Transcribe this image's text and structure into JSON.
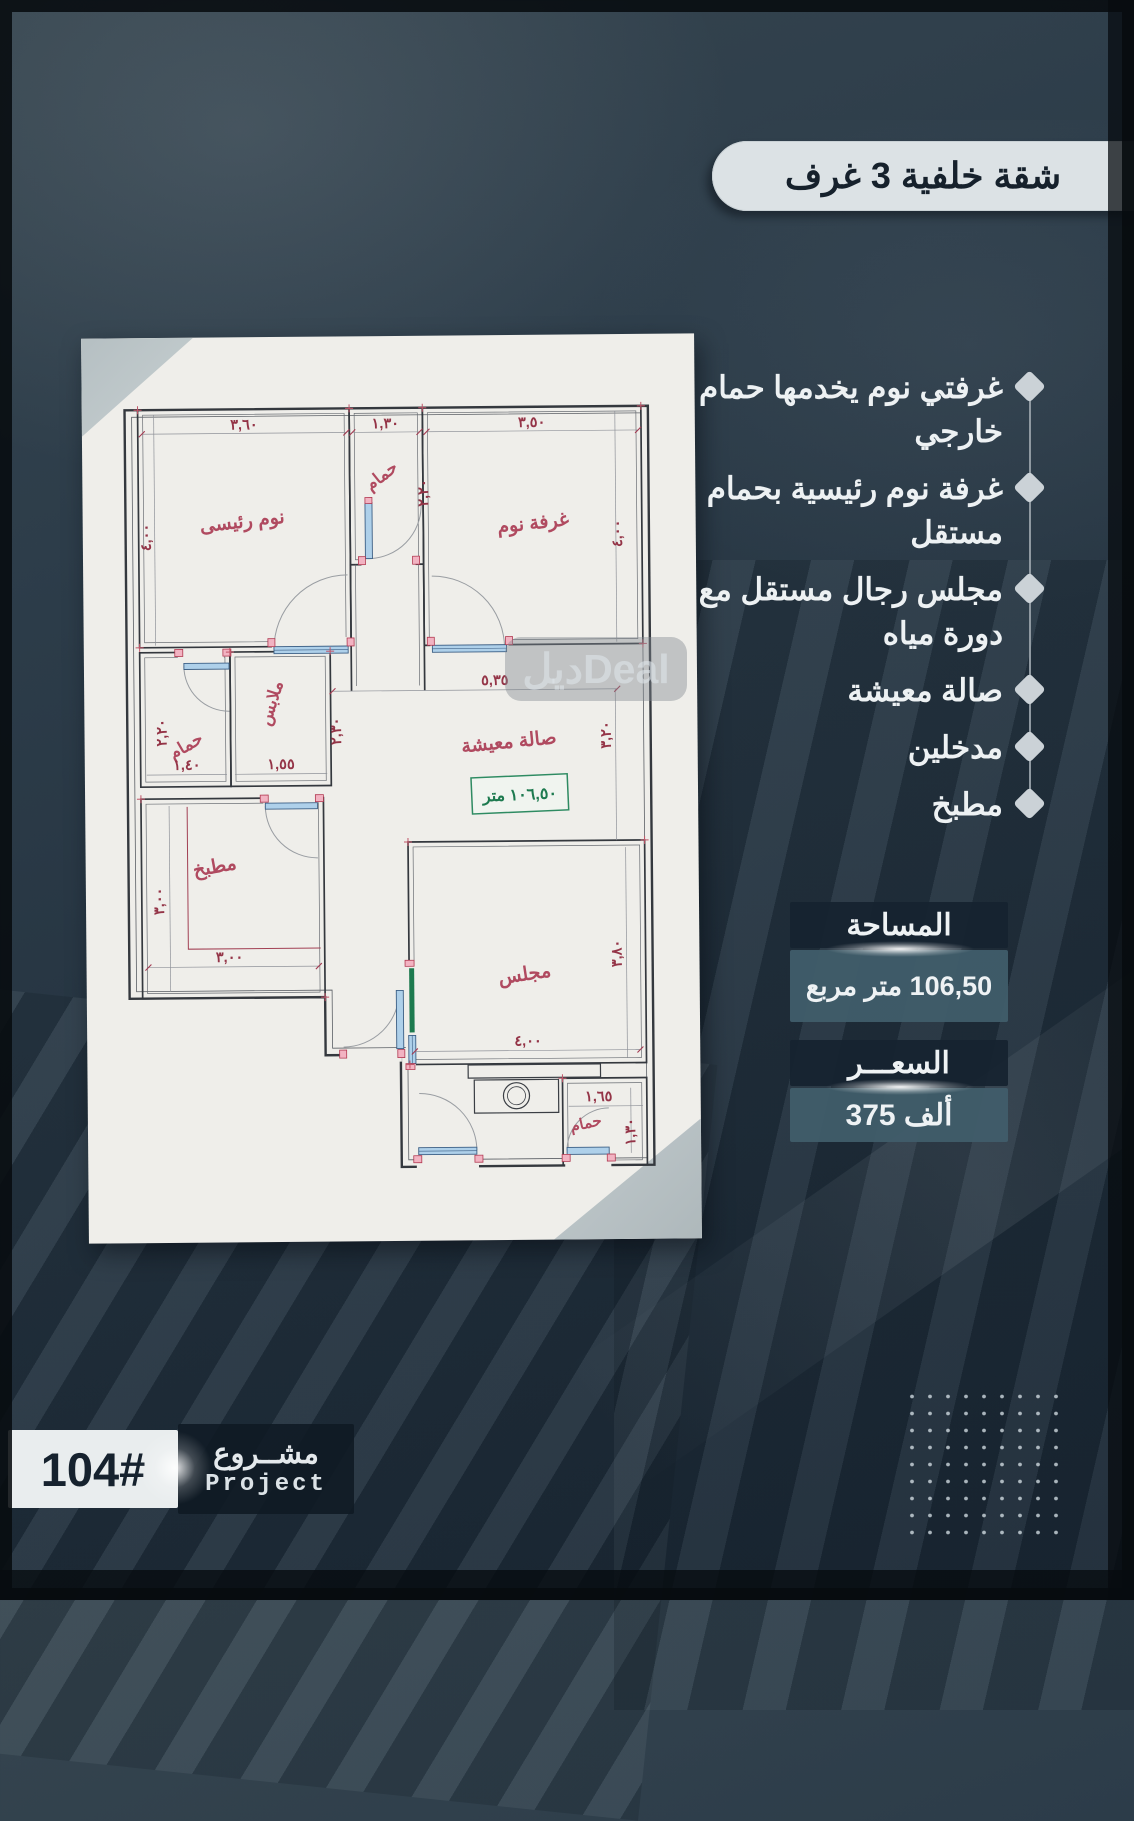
{
  "title": {
    "label": "شقة خلفية 3 غرف"
  },
  "features": {
    "items": [
      {
        "label": "غرفتي نوم يخدمها حمام خارجي"
      },
      {
        "label": "غرفة نوم رئيسية بحمام مستقل"
      },
      {
        "label": "مجلس رجال مستقل مع دورة مياه"
      },
      {
        "label": "صالة معيشة"
      },
      {
        "label": "مدخلين"
      },
      {
        "label": "مطبخ"
      }
    ]
  },
  "area": {
    "header": "المساحة",
    "value": "106,50 متر مربع"
  },
  "price": {
    "header": "السعـــر",
    "value": "375 ألف"
  },
  "project": {
    "number": "104#",
    "title_ar": "مشــروع",
    "title_en": "Project"
  },
  "watermark": {
    "text": "ديلDeal"
  },
  "floorplan": {
    "rooms": {
      "master": "نوم رئيسى",
      "bath_top": "حمام",
      "bedroom": "غرفة نوم",
      "hall": "صالة معيشة",
      "closet": "ملابس",
      "bath_left": "حمام",
      "kitchen": "مطبخ",
      "majlis": "مجلس",
      "bath_bottom": "حمام"
    },
    "dims": {
      "master_w": "٣,٦٠",
      "bath_top_w": "١,٣٠",
      "bedroom_w": "٣,٥٠",
      "master_h": "٤,٠٠",
      "bath_top_h": "٢,٢٠",
      "bedroom_h": "٤,٠٠",
      "hall_w": "٥,٣٥",
      "hall_h": "٣,٢٠",
      "bath_left_w": "١,٤٠",
      "closet_w": "١,٥٥",
      "bath_left_h": "٢,٢٠",
      "closet_h": "٢,٣٠",
      "kitchen_w": "٣,٠٠",
      "kitchen_h": "٣,٠٠",
      "majlis_w": "٤,٠٠",
      "majlis_h": "٣,٨٠",
      "bath_bottom_w": "١,٦٥",
      "bath_bottom_h": "١,٣٠"
    },
    "area_box": "١٠٦,٥٠ متر"
  },
  "colors": {
    "background": "#27364 3",
    "panel_dark": "#162330",
    "panel_teal": "#405d6a",
    "pill": "#dce2e5",
    "plan_wall": "#34383e",
    "plan_red": "#a43b52",
    "plan_green": "#1d7a4f",
    "plan_blue": "#aed0ea"
  }
}
